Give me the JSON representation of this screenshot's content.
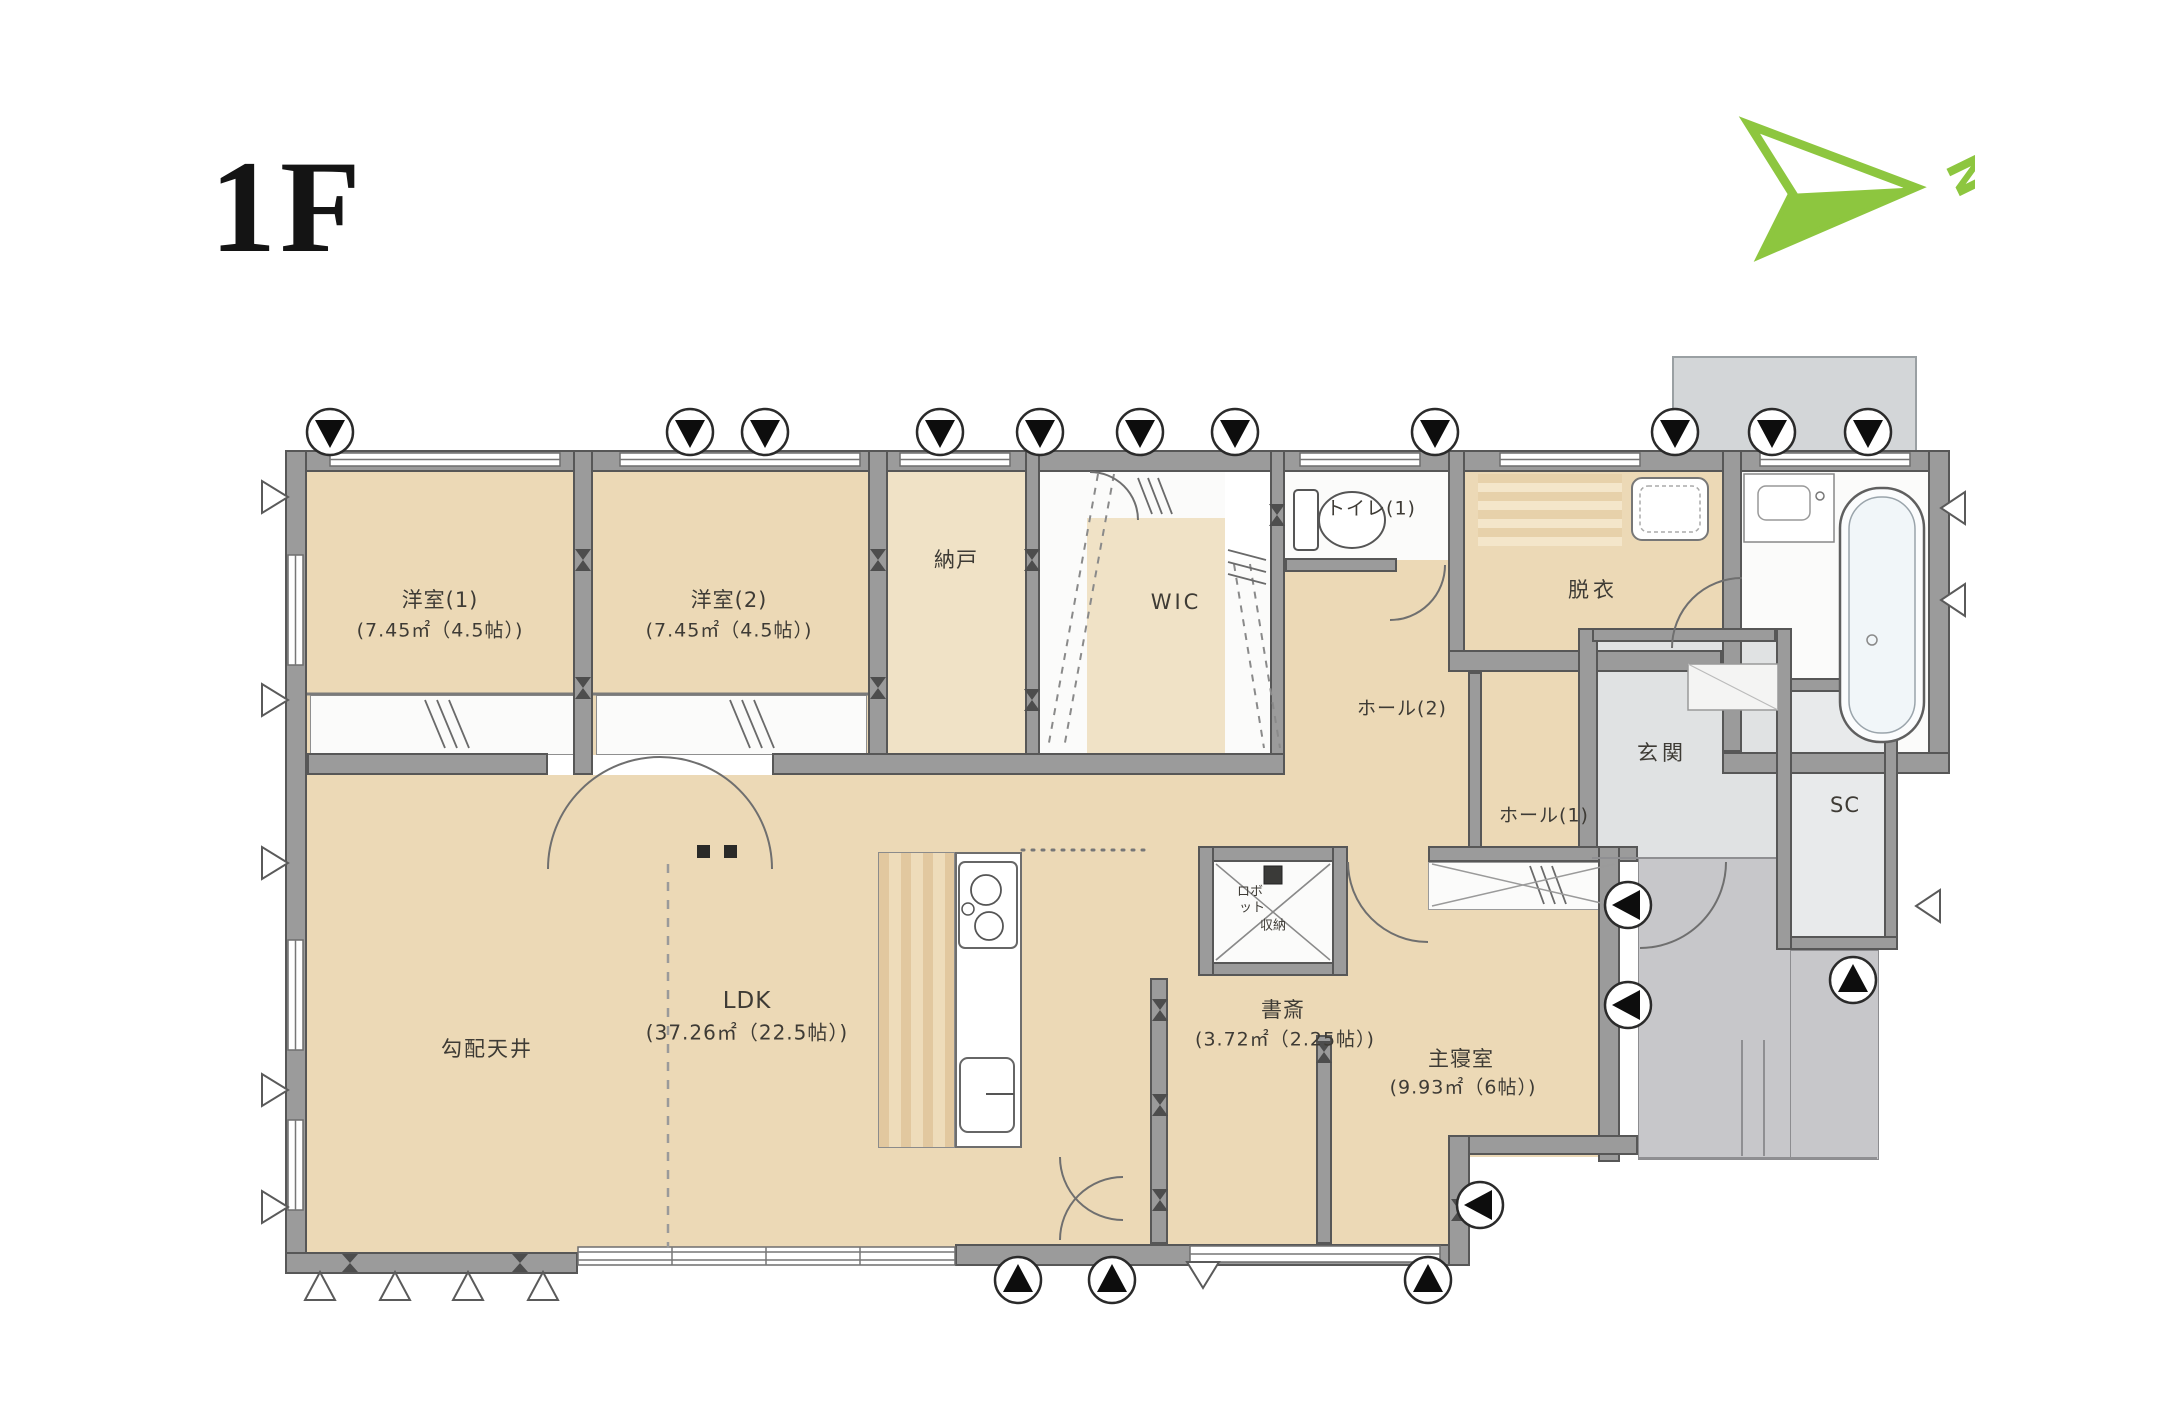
{
  "title": "1F",
  "compass": {
    "direction": "N",
    "color": "#8dc63f",
    "icon": "north-arrow-icon"
  },
  "rooms": {
    "yoshitsu1": {
      "name": "洋室(1)",
      "area": "(7.45㎡（4.5帖）)"
    },
    "yoshitsu2": {
      "name": "洋室(2)",
      "area": "(7.45㎡（4.5帖）)"
    },
    "nando": {
      "name": "納戸"
    },
    "wic": {
      "name": "WIC"
    },
    "toilet1": {
      "name": "トイレ(1)"
    },
    "datsui": {
      "name": "脱衣"
    },
    "hall2": {
      "name": "ホール(2)"
    },
    "hall1": {
      "name": "ホール(1)"
    },
    "genkan": {
      "name": "玄関"
    },
    "sc": {
      "name": "SC"
    },
    "ldk": {
      "name": "LDK",
      "area": "(37.26㎡（22.5帖）)"
    },
    "kobai": {
      "name": "勾配天井"
    },
    "shosai": {
      "name": "書斎",
      "area": "(3.72㎡（2.25帖）)"
    },
    "bedroom": {
      "name": "主寝室",
      "area": "(9.93㎡（6帖）)"
    },
    "storage": {
      "line1": "ロボ",
      "line2": "ット",
      "line3": "収納"
    }
  },
  "symbols": {
    "vent_marker": "black-triangle-circle-vent-icon",
    "opening_marker": "white-triangle-vent-icon",
    "brace_marker": "bowtie-brace-icon",
    "fixtures": [
      "bathtub-icon",
      "toilet-icon",
      "washing-machine-icon",
      "vanity-sink-icon",
      "kitchen-stove-icon",
      "kitchen-sink-icon"
    ]
  },
  "colors": {
    "floor_wood": "#ecd9b6",
    "wall": "#9b9b9b",
    "porch": "#c7c7ca",
    "accent_green": "#8dc63f"
  }
}
